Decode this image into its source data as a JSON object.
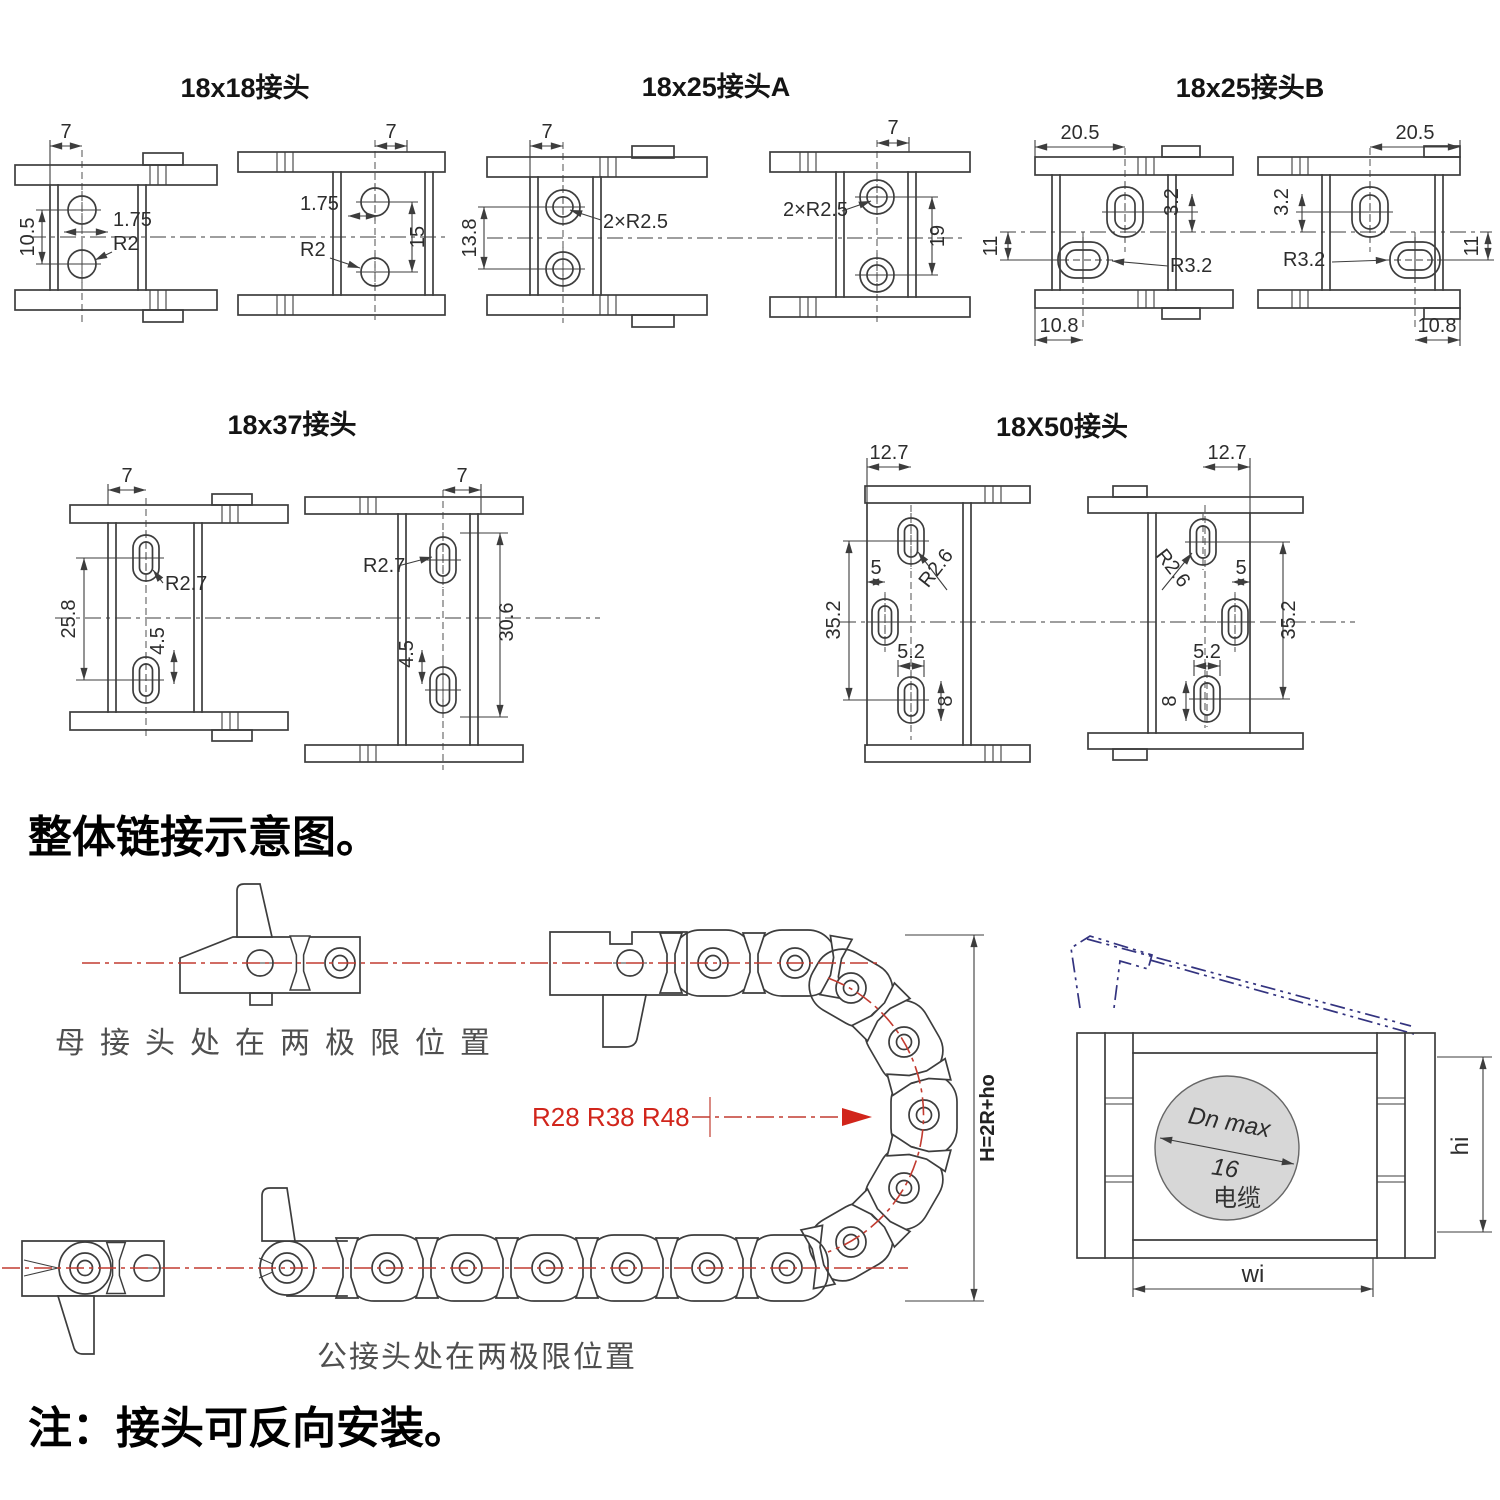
{
  "colors": {
    "line": "#3d3d3d",
    "centerline_red": "#c23b30",
    "annotation_red": "#d1251b",
    "cover_blue": "#33337f",
    "cable_fill": "#d7d7d7"
  },
  "panels": [
    {
      "title": "18x18接头",
      "left": {
        "d1": "7",
        "d2": "10.5",
        "d3": "1.75",
        "d4": "R2"
      },
      "right": {
        "d1": "7",
        "d2": "1.75",
        "d3": "R2",
        "d4": "15"
      }
    },
    {
      "title": "18x25接头A",
      "left": {
        "d1": "7",
        "d2": "13.8",
        "d3": "2×R2.5"
      },
      "right": {
        "d1": "7",
        "d2": "2×R2.5",
        "d3": "19"
      }
    },
    {
      "title": "18x25接头B",
      "left": {
        "d1": "20.5",
        "d2": "3.2",
        "d3": "11",
        "d4": "R3.2",
        "d5": "10.8"
      },
      "right": {
        "d1": "20.5",
        "d2": "3.2",
        "d3": "11",
        "d4": "R3.2",
        "d5": "10.8"
      }
    },
    {
      "title": "18x37接头",
      "left": {
        "d1": "7",
        "d2": "25.8",
        "d3": "R2.7",
        "d4": "4.5"
      },
      "right": {
        "d1": "7",
        "d2": "R2.7",
        "d3": "30.6",
        "d4": "4.5"
      }
    },
    {
      "title": "18X50接头",
      "left": {
        "d1": "12.7",
        "d2": "35.2",
        "d3": "5",
        "d4": "R2.6",
        "d5": "5.2",
        "d6": "8"
      },
      "right": {
        "d1": "12.7",
        "d2": "R2.6",
        "d3": "5",
        "d4": "35.2",
        "d5": "5.2",
        "d6": "8"
      }
    }
  ],
  "assembly": {
    "heading": "整体链接示意图。",
    "female_position_label": "母接头处在两极限位置",
    "male_position_label": "公接头处在两极限位置",
    "bend_radius_label": "R28 R38 R48",
    "height_formula": "H=2R+ho"
  },
  "cross_section": {
    "diameter_label": "Dn max",
    "diameter_value": "16",
    "cable_label": "电缆",
    "inner_width_label": "wi",
    "inner_height_label": "hi"
  },
  "note": "注：接头可反向安装。"
}
